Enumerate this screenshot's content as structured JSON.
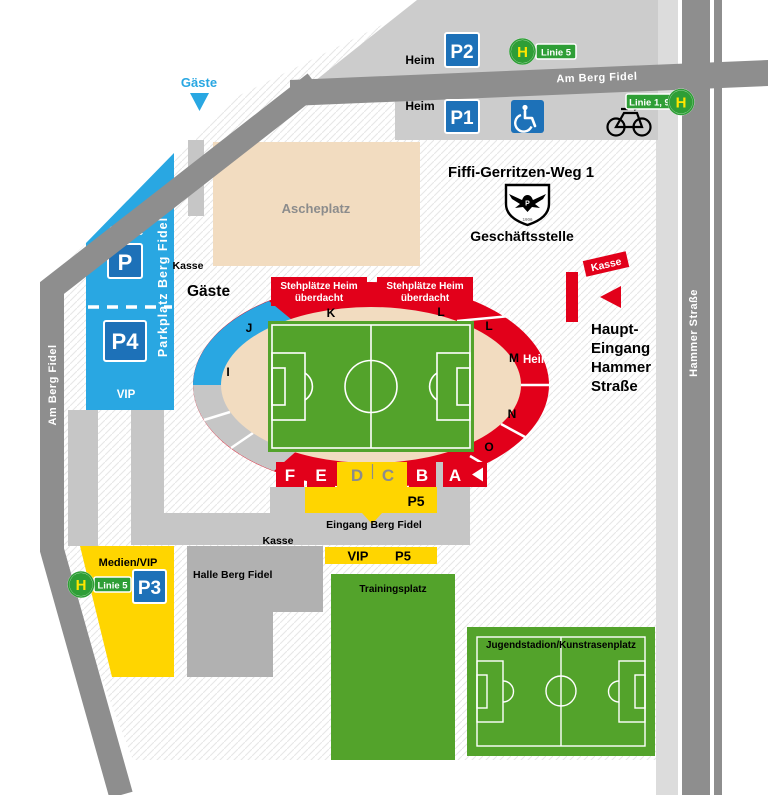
{
  "common": {
    "kasse": "Kasse",
    "heim": "Heim",
    "gaeste": "Gäste",
    "p5": "P5",
    "vip": "VIP"
  },
  "streets": {
    "am_berg_fidel": "Am Berg Fidel",
    "hammer_strasse": "Hammer Straße"
  },
  "transit": {
    "stop_letter": "H",
    "linie_5": "Linie 5",
    "linie_1_9": "Linie 1, 9"
  },
  "top_parking": {
    "p2": "P2",
    "p1": "P1"
  },
  "office": {
    "address": "Fiffi-Gerritzen-Weg 1",
    "name": "Geschäftsstelle",
    "crest": "preussen-muenster-crest"
  },
  "ascheplatz": {
    "label": "Ascheplatz"
  },
  "parking_west": {
    "p": "P",
    "p4": "P4",
    "side_label": "Parkplatz Berg Fidel"
  },
  "stadium": {
    "roof_line1": "Stehplätze Heim",
    "roof_line2": "überdacht",
    "sections": {
      "i": "I",
      "j": "J",
      "k": "K",
      "l_top": "L",
      "l_corner": "L",
      "m": "M",
      "n": "N",
      "o": "O"
    },
    "south_blocks": {
      "f": "F",
      "e": "E",
      "d": "D",
      "c": "C",
      "b": "B",
      "a": "A"
    }
  },
  "main_entrance": {
    "lines": [
      "Haupt-",
      "Eingang",
      "Hammer",
      "Straße"
    ]
  },
  "south": {
    "eingang": "Eingang Berg Fidel",
    "halle": "Halle Berg Fidel"
  },
  "parking_south": {
    "medien_vip": "Medien/VIP",
    "p3": "P3"
  },
  "fields": {
    "trainingsplatz": "Trainingsplatz",
    "jugendstadion": "Jugendstadion/Kunstrasenplatz"
  },
  "colors": {
    "road": "#8E8E8E",
    "parking_gray": "#CCCCCC",
    "ped_gray": "#C6C6C6",
    "building_gray": "#B1B1B1",
    "beige": "#F2DCC0",
    "blue": "#29A7E2",
    "sign_blue": "#1D71B8",
    "red": "#E2001A",
    "yellow": "#FFD500",
    "green": "#53A32B",
    "bus_green": "#2E9E36",
    "bus_yellow": "#FFE600"
  }
}
